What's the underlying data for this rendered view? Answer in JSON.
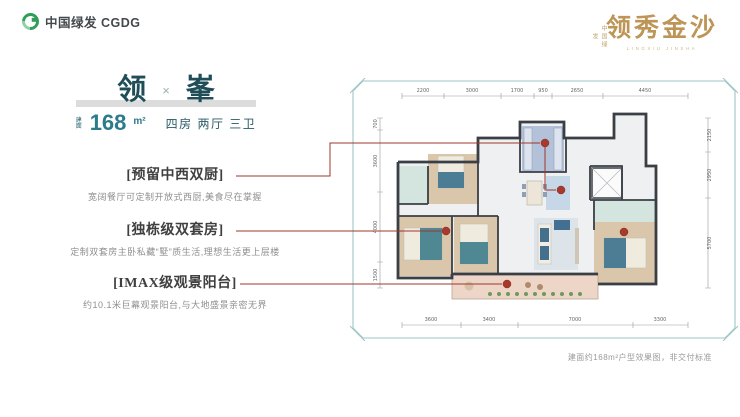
{
  "header": {
    "logo_text": "中国绿发 CGDG",
    "brand_vertical": "中国绿发",
    "brand_name": "领秀金沙",
    "brand_sub": "LINGXIU JINSHA"
  },
  "unit": {
    "title_left": "领",
    "title_sep": "×",
    "title_right": "峯",
    "area_label": "建面",
    "area_value": "168",
    "area_unit": "m²",
    "rooms": "四房 两厅 三卫"
  },
  "features": [
    {
      "title": "[预留中西双厨]",
      "desc": "宽阔餐厅可定制开放式西厨,美食尽在掌握"
    },
    {
      "title": "[独栋级双套房]",
      "desc": "定制双套房主卧私藏“墅”质生活,理想生活更上层楼"
    },
    {
      "title": "[IMAX级观景阳台]",
      "desc": "约10.1米巨幕观景阳台,与大地盛景亲密无界"
    }
  ],
  "plan": {
    "dims_top": [
      "2200",
      "3000",
      "1700",
      "950",
      "2650",
      "4450"
    ],
    "dims_bottom": [
      "3600",
      "3400",
      "7000",
      "3300"
    ],
    "dims_left": [
      "700",
      "3600",
      "4000",
      "1500"
    ],
    "dims_right": [
      "2150",
      "2950",
      "5700"
    ]
  },
  "disclaimer": "建面约168m²户型效果图，非交付标准",
  "colors": {
    "accent_teal": "#2c7b8a",
    "title_teal": "#1f4e58",
    "frame_teal": "#9fc6c6",
    "leader_red": "#9e372b",
    "gold": "#bd9556",
    "wall": "#3a3f45"
  }
}
